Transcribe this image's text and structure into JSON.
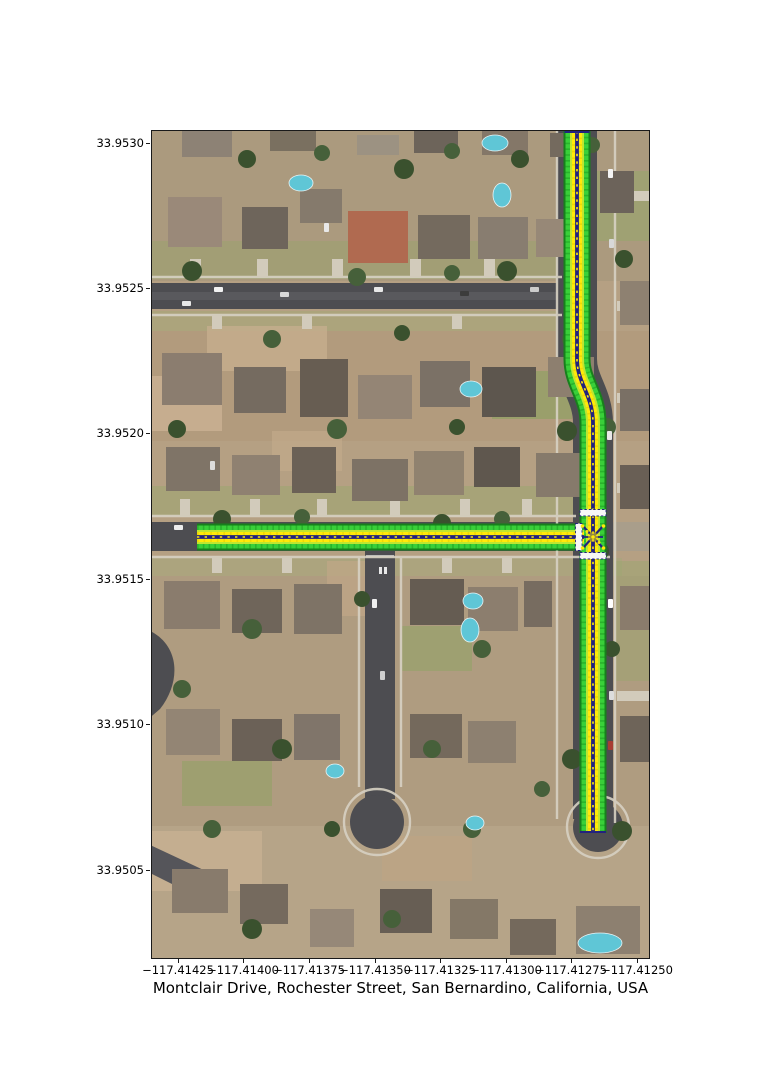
{
  "figure": {
    "title": "Montclair Drive, Rochester Street, San Bernardino, California, USA",
    "x_axis": {
      "ticks": [
        "−117.41425",
        "−117.41400",
        "−117.41375",
        "−117.41350",
        "−117.41325",
        "−117.41300",
        "−117.41275",
        "−117.41250"
      ]
    },
    "y_axis": {
      "ticks": [
        "33.9530",
        "33.9525",
        "33.9520",
        "33.9515",
        "33.9510",
        "33.9505"
      ]
    }
  },
  "map": {
    "type": "satellite imagery with lane-level road overlay",
    "highlighted_streets": [
      "Montclair Drive",
      "Rochester Street"
    ],
    "city": "San Bernardino",
    "state": "California",
    "country": "USA",
    "overlay_colors": {
      "lane_edge_dark_green": "#17801c",
      "lane_edge_green": "#39d039",
      "lane_inner_yellow_green": "#bfe530",
      "lane_center_yellow": "#ffe90a",
      "centerline_navy": "#22227f",
      "stop_bar_white": "#f7f7f7"
    }
  }
}
